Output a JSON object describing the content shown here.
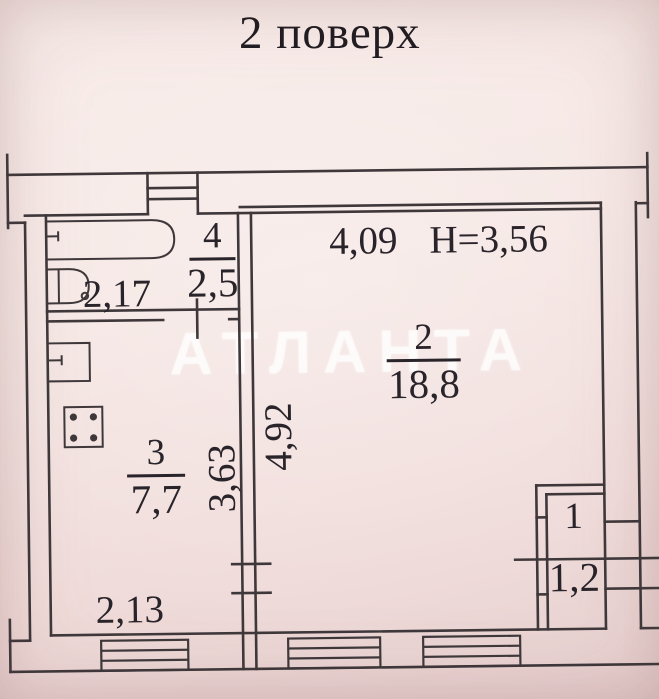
{
  "title": "2 поверх",
  "watermark": "АТЛАНТА",
  "rooms": [
    {
      "number": "1",
      "area": "1,2"
    },
    {
      "number": "2",
      "area": "18,8"
    },
    {
      "number": "3",
      "area": "7,7"
    },
    {
      "number": "4",
      "area": "2,5"
    }
  ],
  "dimensions": {
    "bathroom_width": "2,17",
    "kitchen_width": "2,13",
    "kitchen_depth": "3,63",
    "room2_width": "4,09",
    "room2_depth": "4,92",
    "ceiling_height": "H=3,56"
  },
  "symbols": [
    "bathtub",
    "washbasin",
    "kitchen-sink",
    "stove",
    "window",
    "vent-shaft"
  ],
  "colors": {
    "paper": "#f5e6e3",
    "ink": "#3f383b",
    "text": "#29232a",
    "watermark": "rgba(255,255,255,0.62)"
  }
}
